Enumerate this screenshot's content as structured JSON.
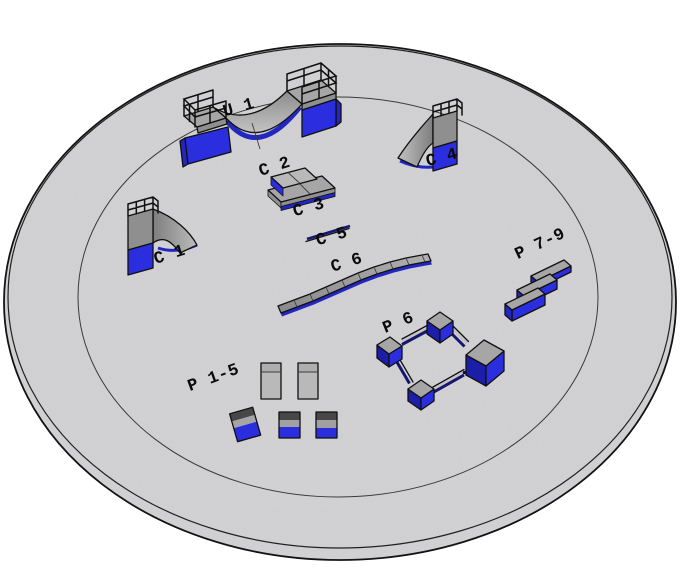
{
  "scene": {
    "kind": "3d-isometric-render",
    "platform": {
      "shape": "large circular concrete pad",
      "ring_markings": 2
    },
    "labels": {
      "u1": "U 1",
      "c1": "C 1",
      "c2": "C 2",
      "c3": "C 3",
      "c4": "C 4",
      "c5": "C 5",
      "c6": "C 6",
      "p1_5": "P 1-5",
      "p6": "P 6",
      "p7_9": "P 7-9"
    },
    "objects": [
      {
        "id": "u1",
        "label": "U 1",
        "kind": "halfpipe-with-railings"
      },
      {
        "id": "c1",
        "label": "C 1",
        "kind": "quarterpipe-ramp"
      },
      {
        "id": "c2",
        "label": "C 2",
        "kind": "stacked-pad"
      },
      {
        "id": "c3",
        "label": "C 3",
        "kind": "base-pad"
      },
      {
        "id": "c4",
        "label": "C 4",
        "kind": "quarterpipe-ramp"
      },
      {
        "id": "c5",
        "label": "C 5",
        "kind": "flat-rail"
      },
      {
        "id": "c6",
        "label": "C 6",
        "kind": "curved-segmented-ledge"
      },
      {
        "id": "p1_5",
        "label": "P 1-5",
        "kind": "pads-and-boxes"
      },
      {
        "id": "p6",
        "label": "P 6",
        "kind": "boxes-connected-by-rails"
      },
      {
        "id": "p7_9",
        "label": "P 7-9",
        "kind": "three-angled-ledges"
      }
    ]
  },
  "colors": {
    "bg": "#ffffff",
    "floor": "#d4d4d6",
    "outline": "#101010",
    "rim_line": "#1a1a1a",
    "ring_line": "#3a3a3a",
    "seam": "#3c3c3c",
    "gray_top": "#a6a6a6",
    "gray_lite": "#b9b9b9",
    "gray_mid": "#8f8f8f",
    "gray_dark": "#474747",
    "rail_top": "#c4c4c4",
    "blue_bright": "#2b2ede",
    "blue_mid": "#2327c2",
    "blue_dark": "#1b1ea6",
    "navy_rail": "#15166e",
    "label": "#0a0a0a"
  }
}
